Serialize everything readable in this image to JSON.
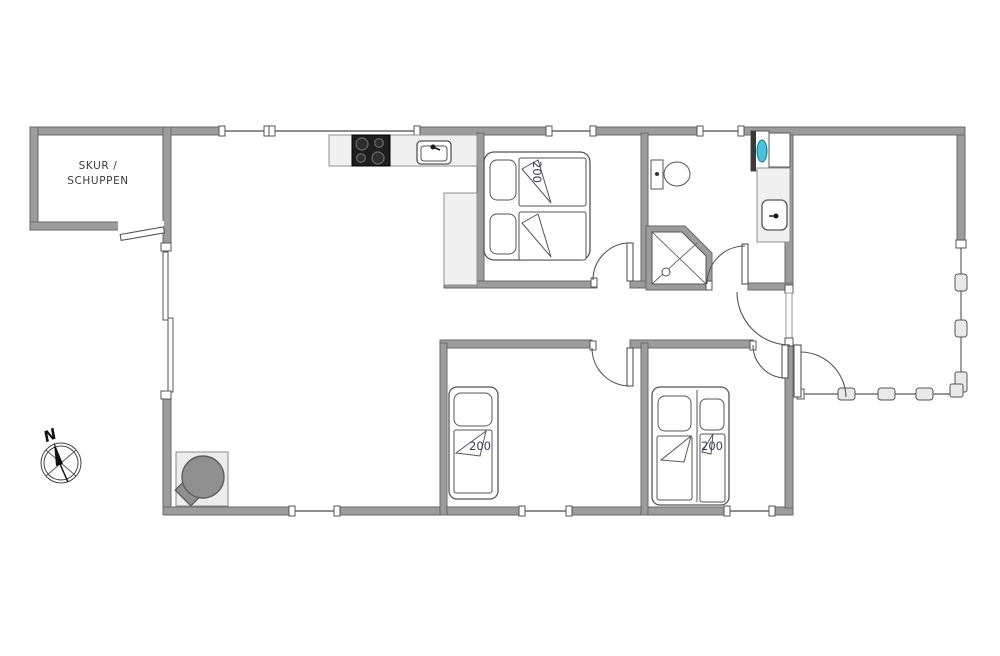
{
  "colors": {
    "wall_fill": "#9c9c9c",
    "wall_edge": "#6a6a6a",
    "counter_fill": "#f0f0f0",
    "stove_fill": "#1e1e1e",
    "appliance_accent": "#44c3de",
    "label_color": "#3a3a55",
    "fence_post_fill": "#e9e9e9"
  },
  "shed": {
    "label_line1": "SKUR /",
    "label_line2": "SCHUPPEN"
  },
  "compass": {
    "north_label": "N"
  },
  "beds": {
    "double_bed": {
      "size_label": "200"
    },
    "single_bed_left": {
      "size_label": "200"
    },
    "single_bed_right": {
      "size_label": "200"
    }
  },
  "fixtures": {
    "cooktop": "cooktop-4-burner",
    "kitchen_sink": "kitchen-sink",
    "toilet": "toilet",
    "shower": "corner-shower",
    "washbasin": "washbasin",
    "water_heater": "water-heater",
    "wood_stove": "wood-burning-stove",
    "terrace_fence": "fence-with-posts"
  }
}
